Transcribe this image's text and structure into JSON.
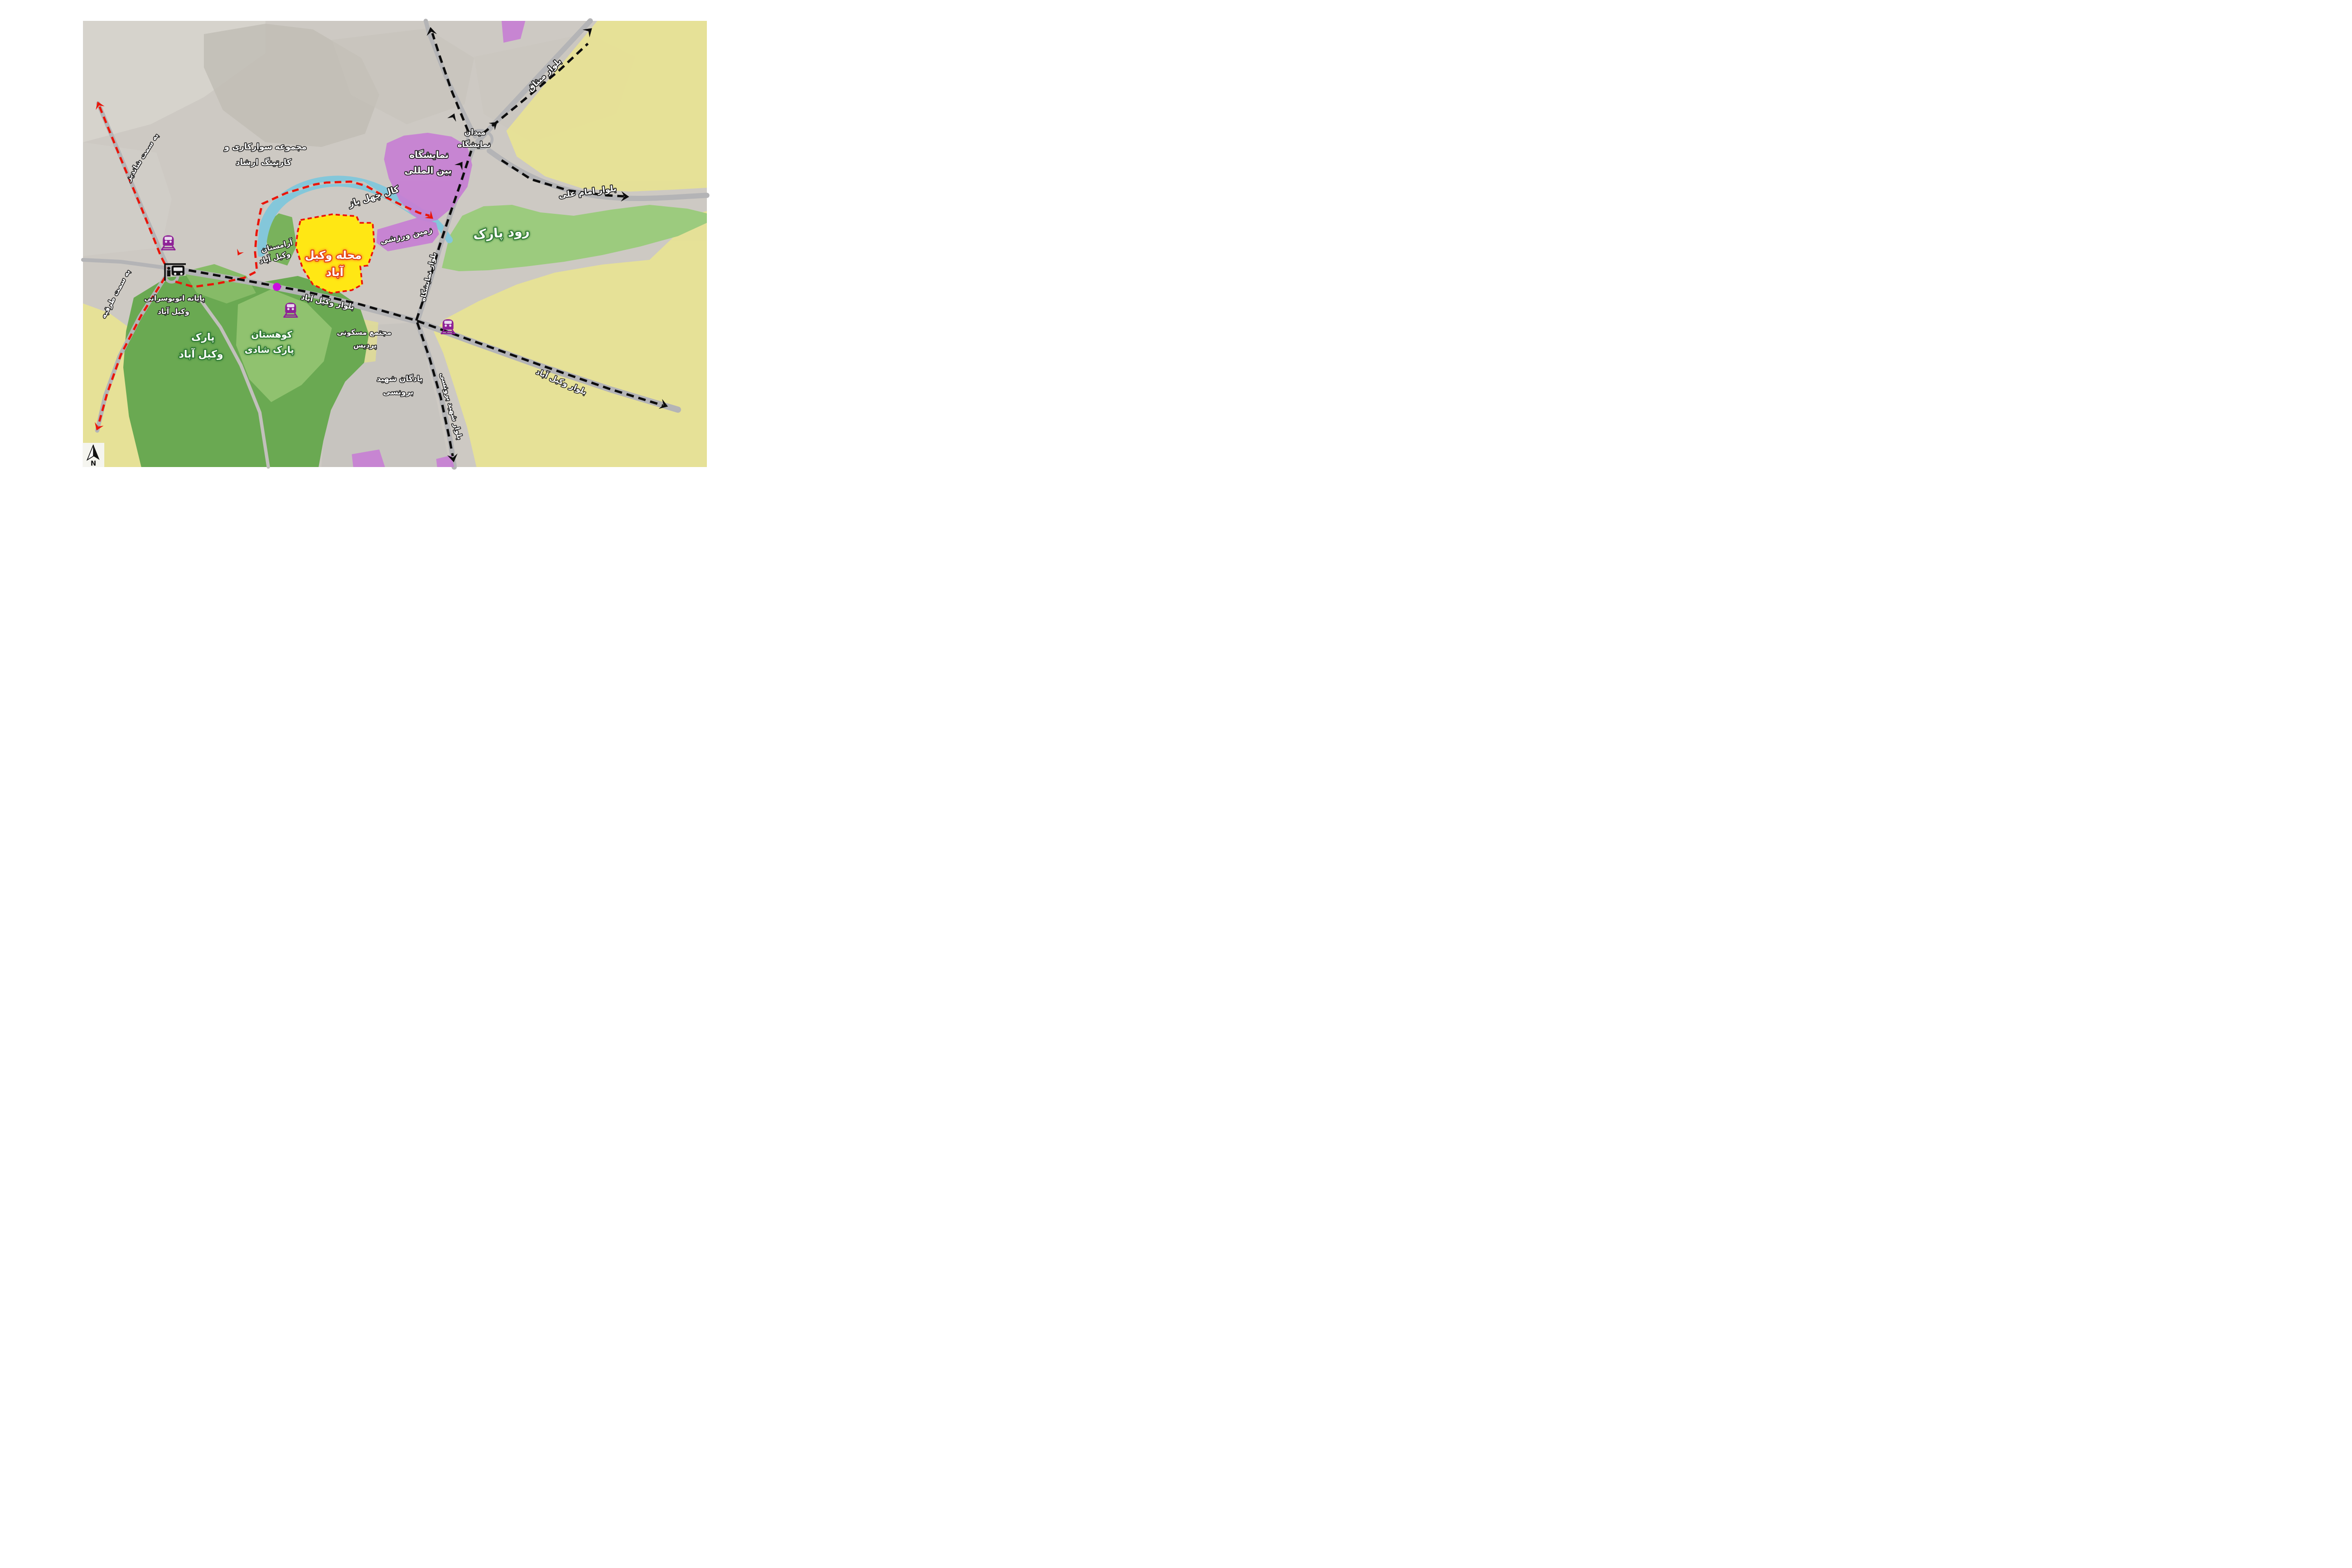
{
  "map": {
    "kind": "urban land-use map overlay on satellite imagery",
    "area": "Vakil Abad"
  },
  "labels": {
    "equestrian_l1": "مجموعه سوارکاری و",
    "equestrian_l2": "کارتینگ ارشاد",
    "river_name": "کال چهل باز",
    "exhibition_l1": "نمایشگاه",
    "exhibition_l2": "بین المللی",
    "exhibition_square_l1": "میدان",
    "exhibition_square_l2": "نمایشگاه",
    "misagh_blvd": "بلوار میثاق",
    "imam_ali_blvd": "بلوار امام علی",
    "rud_park": "رود پارک",
    "sports_field": "زمین ورزشی",
    "cemetery_l1": "آرامستان",
    "cemetery_l2": "وکیل آباد",
    "neighborhood_l1": "محله وکیل",
    "neighborhood_l2": "آباد",
    "bus_terminal_l1": "پایانه اتوبوسرانی",
    "bus_terminal_l2": "وکیل آباد",
    "to_shandiz": "به سمت شاندیز",
    "to_torqabeh": "به سمت طرقبه",
    "vakilabad_blvd_center": "بلوار وکیل آباد",
    "vakilabad_blvd_east": "بلوار وکیل آباد",
    "pardis_l1": "مجتمع مسکونی",
    "pardis_l2": "پردیس",
    "barracks_l1": "پادگان شهید",
    "barracks_l2": "برونسی",
    "boroonsi_blvd": "بلوار شهید برونسی",
    "namayeshgah_blvd": "بلوار نمایشگاه",
    "shadi_park_l1": "کوهستان",
    "shadi_park_l2": "پارک شادی",
    "vakilabad_park_l1": "پارک",
    "vakilabad_park_l2": "وکیل آباد",
    "north_letter": "N"
  },
  "colors": {
    "residential_zone_yellow": "#e9e491",
    "neighborhood_highlight_yellow": "#ffe714",
    "park_dark_green": "#6aa952",
    "park_light_green": "#9ccb7e",
    "river_blue": "#84c7da",
    "exhibition_purple": "#c77fd4",
    "road_gray": "#b4b4b6",
    "transit_line_black": "#0d0d0d",
    "route_red": "#ea1509",
    "metro_icon_purple": "#8e2196",
    "station_dot_magenta": "#cb0de0",
    "label_text_white": "#ffffff"
  }
}
